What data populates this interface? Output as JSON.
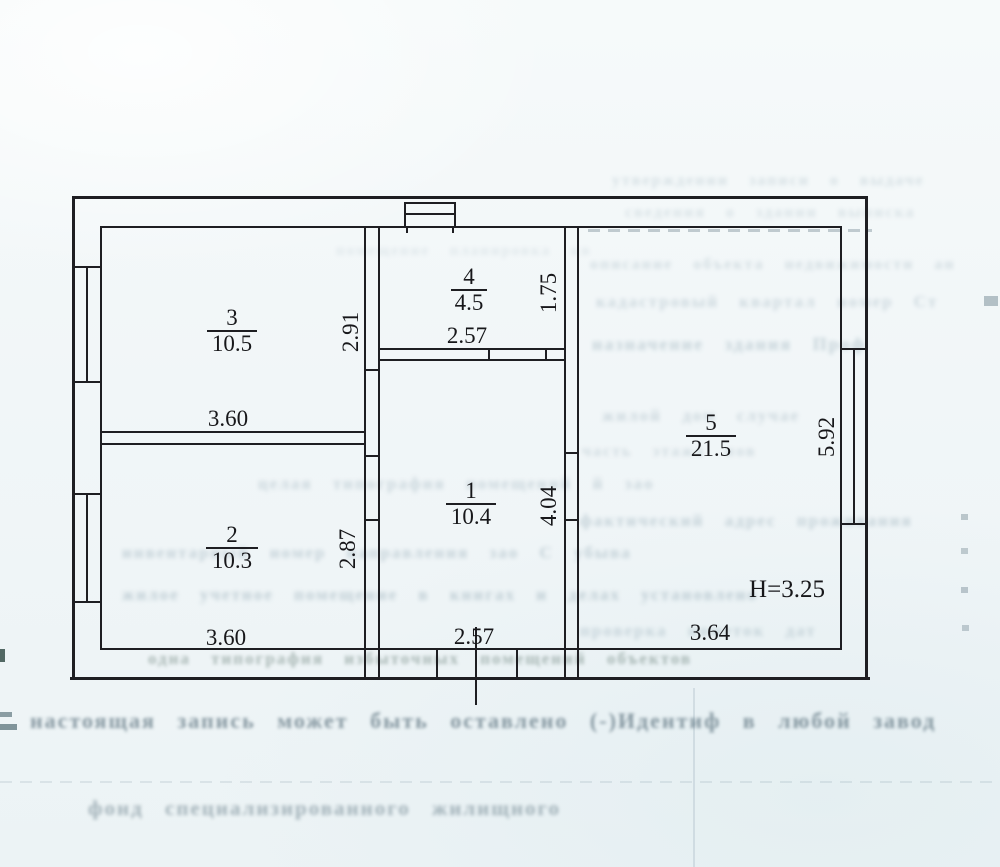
{
  "page": {
    "width": 1000,
    "height": 867,
    "background": "#f1f6f8"
  },
  "colors": {
    "ink": "#1e1e22",
    "ghost": "#5d7d8e",
    "ghost_dark": "#415a68"
  },
  "plan": {
    "note": "BTI-style apartment floor plan; room number over area (m2); wall dimensions in metres",
    "lines": [
      [
        72,
        196,
        796,
        3
      ],
      [
        70,
        677,
        800,
        3
      ],
      [
        72,
        196,
        3,
        484
      ],
      [
        865,
        196,
        3,
        484
      ],
      [
        100,
        226,
        742,
        2
      ],
      [
        100,
        648,
        742,
        2
      ],
      [
        100,
        226,
        2,
        424
      ],
      [
        840,
        226,
        2,
        424
      ],
      [
        364,
        226,
        2,
        424
      ],
      [
        378,
        226,
        2,
        424
      ],
      [
        364,
        369,
        16,
        2
      ],
      [
        364,
        455,
        16,
        2
      ],
      [
        364,
        519,
        16,
        2
      ],
      [
        100,
        431,
        266,
        2
      ],
      [
        100,
        443,
        266,
        2
      ],
      [
        380,
        348,
        185,
        2
      ],
      [
        380,
        359,
        185,
        2
      ],
      [
        488,
        348,
        2,
        13
      ],
      [
        545,
        348,
        2,
        13
      ],
      [
        564,
        226,
        2,
        424
      ],
      [
        577,
        226,
        2,
        424
      ],
      [
        564,
        452,
        15,
        2
      ],
      [
        564,
        519,
        15,
        2
      ],
      [
        364,
        650,
        2,
        27
      ],
      [
        378,
        650,
        2,
        27
      ],
      [
        564,
        650,
        2,
        27
      ],
      [
        577,
        650,
        2,
        27
      ],
      [
        436,
        650,
        2,
        27
      ],
      [
        516,
        650,
        2,
        27
      ],
      [
        475,
        627,
        2,
        78
      ],
      [
        404,
        202,
        52,
        2
      ],
      [
        404,
        213,
        52,
        2
      ],
      [
        404,
        202,
        2,
        26
      ],
      [
        454,
        202,
        2,
        26
      ],
      [
        406,
        228,
        2,
        5
      ],
      [
        452,
        228,
        2,
        5
      ],
      [
        72,
        266,
        28,
        2
      ],
      [
        72,
        381,
        28,
        2
      ],
      [
        86,
        266,
        2,
        117
      ],
      [
        72,
        493,
        28,
        2
      ],
      [
        72,
        601,
        28,
        2
      ],
      [
        86,
        493,
        2,
        110
      ],
      [
        840,
        348,
        28,
        2
      ],
      [
        840,
        523,
        28,
        2
      ],
      [
        853,
        348,
        2,
        177
      ]
    ],
    "rooms": [
      {
        "num": "3",
        "area": "10.5",
        "cx": 232,
        "cy": 331,
        "lw": 50
      },
      {
        "num": "4",
        "area": "4.5",
        "cx": 469,
        "cy": 290,
        "lw": 36
      },
      {
        "num": "2",
        "area": "10.3",
        "cx": 232,
        "cy": 548,
        "lw": 52
      },
      {
        "num": "1",
        "area": "10.4",
        "cx": 471,
        "cy": 504,
        "lw": 50
      },
      {
        "num": "5",
        "area": "21.5",
        "cx": 711,
        "cy": 436,
        "lw": 50
      }
    ],
    "dims": [
      {
        "t": "3.60",
        "cx": 228,
        "cy": 419
      },
      {
        "t": "2.57",
        "cx": 467,
        "cy": 336
      },
      {
        "t": "3.60",
        "cx": 226,
        "cy": 638
      },
      {
        "t": "2.57",
        "cx": 474,
        "cy": 637
      },
      {
        "t": "3.64",
        "cx": 710,
        "cy": 633
      },
      {
        "t": "H=3.25",
        "cx": 787,
        "cy": 590,
        "fs": 25
      }
    ],
    "vdims": [
      {
        "t": "2.91",
        "cx": 351,
        "cy": 332
      },
      {
        "t": "1.75",
        "cx": 549,
        "cy": 293
      },
      {
        "t": "2.87",
        "cx": 348,
        "cy": 549
      },
      {
        "t": "4.04",
        "cx": 549,
        "cy": 506
      },
      {
        "t": "5.92",
        "cx": 827,
        "cy": 437
      }
    ]
  },
  "ghost": {
    "note": "faint mirrored bleed-through text from reverse side of the scanned page, mostly illegible",
    "lines": [
      {
        "t": "утверждении  записи  о  выдаче",
        "x": 612,
        "y": 172,
        "fs": 16,
        "op": 0.2
      },
      {
        "t": "сведения  о  здании  выписка",
        "x": 625,
        "y": 204,
        "fs": 16,
        "op": 0.18
      },
      {
        "t": "помещение  планировка  кв",
        "x": 336,
        "y": 243,
        "fs": 15,
        "op": 0.13
      },
      {
        "t": "описание  объекта  недвижимости  ан",
        "x": 590,
        "y": 256,
        "fs": 16,
        "op": 0.22
      },
      {
        "t": "кадастровый  квартал  номер  Ст",
        "x": 596,
        "y": 292,
        "fs": 17,
        "op": 0.25
      },
      {
        "t": "назначение  здания  Проф",
        "x": 592,
        "y": 334,
        "fs": 18,
        "op": 0.3
      },
      {
        "t": "жилой  дом  случае",
        "x": 602,
        "y": 406,
        "fs": 17,
        "op": 0.25
      },
      {
        "t": "часть  этажа  нов",
        "x": 582,
        "y": 443,
        "fs": 16,
        "op": 0.22
      },
      {
        "t": "целая  типография  помещений  й  зао",
        "x": 258,
        "y": 474,
        "fs": 17,
        "op": 0.26
      },
      {
        "t": "фактический  адрес  проживания",
        "x": 580,
        "y": 511,
        "fs": 17,
        "op": 0.3
      },
      {
        "t": "инвентарный  номер  направления  зао  С  убыва",
        "x": 122,
        "y": 543,
        "fs": 17,
        "op": 0.3
      },
      {
        "t": "жилое  учетное  помещение  в  книгах  и  делах  установлено",
        "x": 122,
        "y": 585,
        "fs": 17,
        "op": 0.33
      },
      {
        "t": "проверка  пометок  дат",
        "x": 580,
        "y": 621,
        "fs": 17,
        "op": 0.27
      },
      {
        "t": "одна  типография  избыточных  помещений  объектов",
        "x": 148,
        "y": 649,
        "fs": 17,
        "op": 0.4,
        "c": "#3f5a50",
        "blur": 1.8
      },
      {
        "t": "настоящая  запись  может  быть  оставлено (-)Идентиф  в  любой  завод",
        "x": 30,
        "y": 708,
        "fs": 22,
        "op": 0.6,
        "c": "#415a68",
        "blur": 1.5
      },
      {
        "t": "фонд  специализированного  жилищного",
        "x": 88,
        "y": 796,
        "fs": 21,
        "op": 0.45,
        "c": "#48626f",
        "blur": 1.8
      }
    ]
  },
  "marks": [
    {
      "type": "rect",
      "x": 0,
      "y": 649,
      "w": 5,
      "h": 13,
      "c": "#1d3a33",
      "op": 0.75
    },
    {
      "type": "rect",
      "x": 0,
      "y": 712,
      "w": 12,
      "h": 5,
      "c": "#27454f",
      "op": 0.5
    },
    {
      "type": "rect",
      "x": 0,
      "y": 724,
      "w": 17,
      "h": 6,
      "c": "#27454f",
      "op": 0.55
    },
    {
      "type": "rect",
      "x": 984,
      "y": 296,
      "w": 14,
      "h": 10,
      "c": "#3f5a68",
      "op": 0.35
    },
    {
      "type": "rect",
      "x": 961,
      "y": 514,
      "w": 7,
      "h": 6,
      "c": "#3f5a68",
      "op": 0.3
    },
    {
      "type": "rect",
      "x": 961,
      "y": 548,
      "w": 7,
      "h": 6,
      "c": "#3f5a68",
      "op": 0.28
    },
    {
      "type": "rect",
      "x": 961,
      "y": 587,
      "w": 7,
      "h": 6,
      "c": "#3f5a68",
      "op": 0.3
    },
    {
      "type": "rect",
      "x": 962,
      "y": 625,
      "w": 7,
      "h": 6,
      "c": "#3f5a68",
      "op": 0.28
    },
    {
      "type": "vline",
      "x": 693,
      "y": 688,
      "w": 2,
      "h": 179,
      "c": "#6a8494",
      "op": 0.18
    },
    {
      "type": "dash",
      "x": 588,
      "y": 229,
      "w": 284,
      "h": 3,
      "c": "#45606e",
      "op": 0.3
    },
    {
      "type": "dash",
      "x": 0,
      "y": 781,
      "w": 1000,
      "h": 2,
      "c": "#6a8494",
      "op": 0.15
    }
  ]
}
